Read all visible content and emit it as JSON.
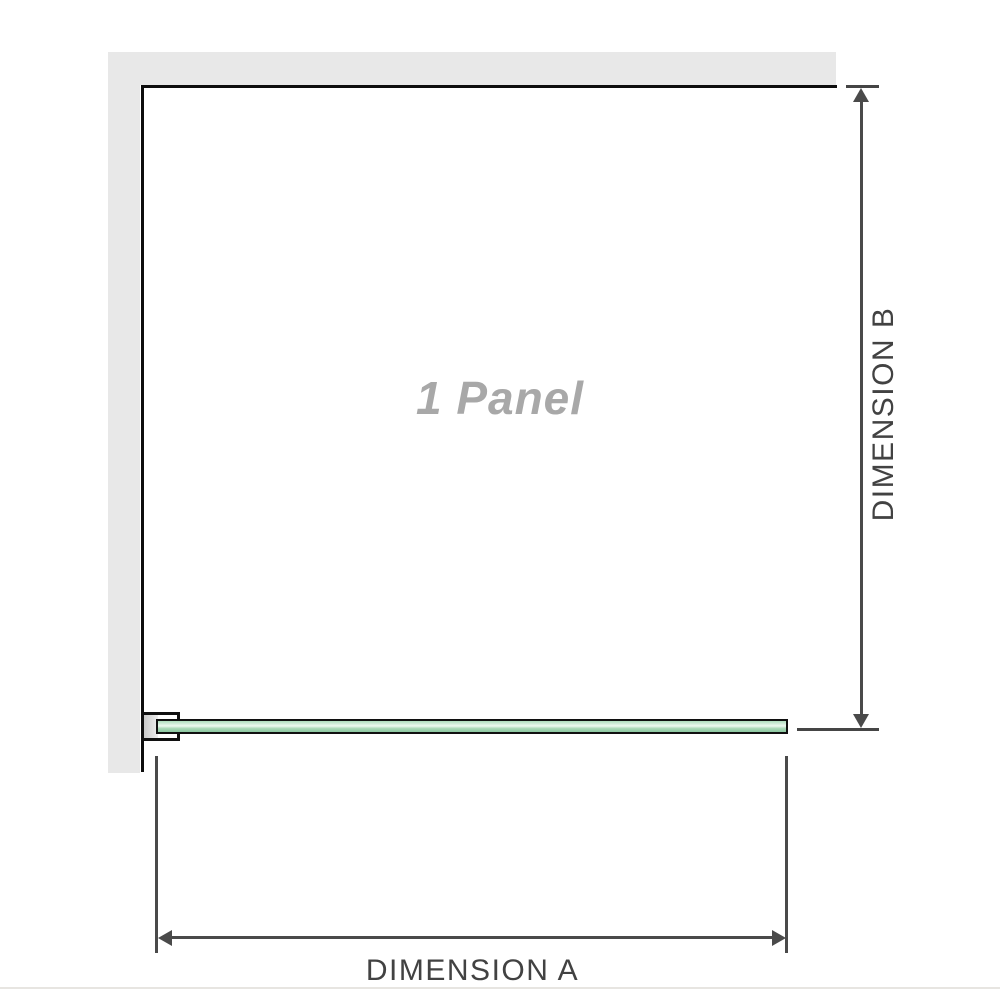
{
  "diagram": {
    "panel_label": "1 Panel",
    "dimensions": {
      "a_label": "DIMENSION A",
      "b_label": "DIMENSION B"
    }
  },
  "colors": {
    "wall": "#e8e8e8",
    "panel_border": "#0d0d0d",
    "dimension_line": "#4a4a4a",
    "dimension_text": "#424242",
    "panel_text": "#a8a8a8",
    "glass_green": "#a9d8b6",
    "glass_highlight": "#edf8ef",
    "glass_shadow": "#8cc8a1",
    "bracket_pad": "#c9c9c9",
    "base_line": "#e7e5e1"
  }
}
